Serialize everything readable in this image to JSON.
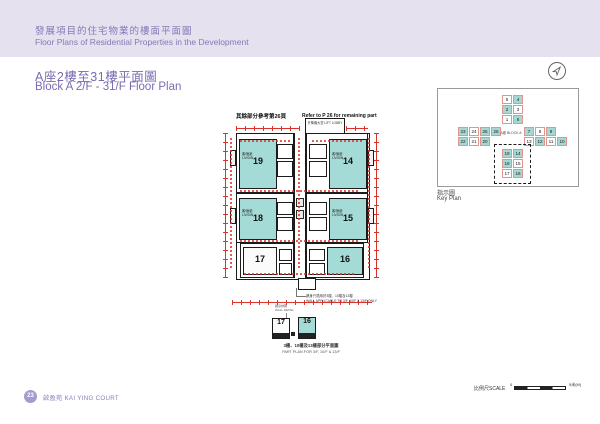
{
  "header_band": {
    "title_zh": "發展項目的住宅物業的樓面平面圖",
    "title_en": "Floor Plans of Residential Properties in the Development"
  },
  "section": {
    "title_zh": "A座2樓至31樓平面圖",
    "title_en": "Block A 2/F - 31/F Floor Plan"
  },
  "main_plan": {
    "ref_note_zh": "其餘部分參考第26頁",
    "ref_note_en": "Refer to P 26 for remaining part",
    "lift_lobby": "升降機大堂 LIFT LOBBY",
    "living_label": "客/飯廳 LIV/DIN",
    "units": [
      {
        "number": "19"
      },
      {
        "number": "14"
      },
      {
        "number": "18"
      },
      {
        "number": "15"
      },
      {
        "number": "17"
      },
      {
        "number": "16"
      }
    ],
    "footnote_zh": "牆身只適用於3樓、10樓及13樓",
    "footnote_en": "WALL APPLICABLE TO 3/F, 10/F & 13/F ONLY"
  },
  "part_plan": {
    "note_zh": "牆身詳圖",
    "note_en": "WALL DETAIL",
    "unit_left": "17",
    "unit_right": "16",
    "caption_zh": "3樓、10樓及13樓部分平面圖",
    "caption_en": "PART PLAN FOR 3/F, 10/F & 13/F"
  },
  "key_plan": {
    "block_label": "A座 BLOCK A",
    "label_zh": "指示圖",
    "label_en": "Key Plan",
    "top_wing_left": [
      "5",
      "2",
      "1"
    ],
    "top_wing_right": [
      "4",
      "3",
      "6"
    ],
    "left_wing_top": [
      "23",
      "24",
      "25",
      "26"
    ],
    "left_wing_bottom": [
      "22",
      "21",
      "20"
    ],
    "right_wing_top": [
      "7",
      "8",
      "9"
    ],
    "right_wing_bottom": [
      "13",
      "12",
      "11",
      "10"
    ],
    "bottom_wing_left": [
      "19",
      "18",
      "17"
    ],
    "bottom_wing_right": [
      "14",
      "15",
      "16"
    ]
  },
  "scale_bar": {
    "label": "比例尺SCALE",
    "start": "0",
    "end": "5米(M)"
  },
  "footer": {
    "page": "23",
    "name": "啟盈苑 KAI YING COURT"
  }
}
